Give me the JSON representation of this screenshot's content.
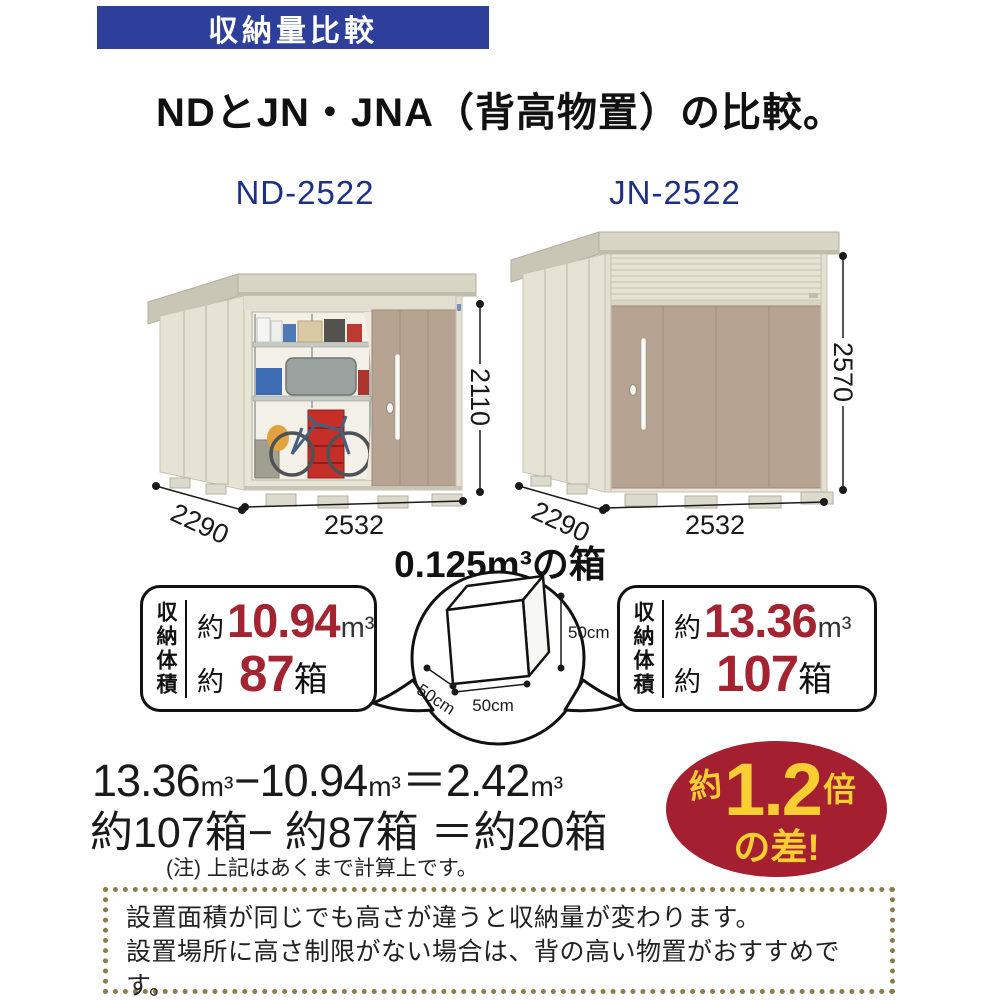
{
  "banner": {
    "title": "収納量比較"
  },
  "heading": "NDとJN・JNA（背高物置）の比較。",
  "sheds": {
    "left": {
      "model": "ND-2522",
      "width": "2532",
      "depth": "2290",
      "height": "2110"
    },
    "right": {
      "model": "JN-2522",
      "width": "2532",
      "depth": "2290",
      "height": "2570"
    }
  },
  "box_demo": {
    "title": "0.125m³の箱",
    "height_label": "50cm",
    "width_label": "50cm",
    "depth_label": "50cm"
  },
  "stats": {
    "left": {
      "label": "収納体積",
      "volume": {
        "approx": "約",
        "value": "10.94",
        "unit": "m³"
      },
      "boxes": {
        "approx": "約",
        "value": "87",
        "unit": "箱"
      }
    },
    "right": {
      "label": "収納体積",
      "volume": {
        "approx": "約",
        "value": "13.36",
        "unit": "m³"
      },
      "boxes": {
        "approx": "約",
        "value": "107",
        "unit": "箱"
      }
    }
  },
  "calculation": {
    "line1": {
      "v1": "13.36",
      "u1": "m³",
      "op1": "−",
      "v2": "10.94",
      "u2": "m³",
      "eq": "＝",
      "v3": "2.42",
      "u3": "m³"
    },
    "line2": "約107箱− 約87箱 ＝約20箱",
    "note": "(注) 上記はあくまで計算上です。"
  },
  "badge": {
    "approx": "約",
    "value": "1.2",
    "times": "倍",
    "line2": "の差!"
  },
  "footer": {
    "lines": [
      "設置面積が同じでも高さが違うと収納量が変わります。",
      "設置場所に高さ制限がない場合は、背の高い物置がおすすめです。",
      "土地を有効に活用できより経済的です。"
    ]
  },
  "colors": {
    "accent_blue": "#2e3f9b",
    "model_blue": "#1e2f8a",
    "value_red": "#a32430",
    "badge_red": "#a41f30",
    "badge_yellow": "#f9ce33",
    "wall_cream": "#e8e5d6",
    "door_tan": "#b7a391",
    "footer_dot": "#8b7d4a"
  }
}
